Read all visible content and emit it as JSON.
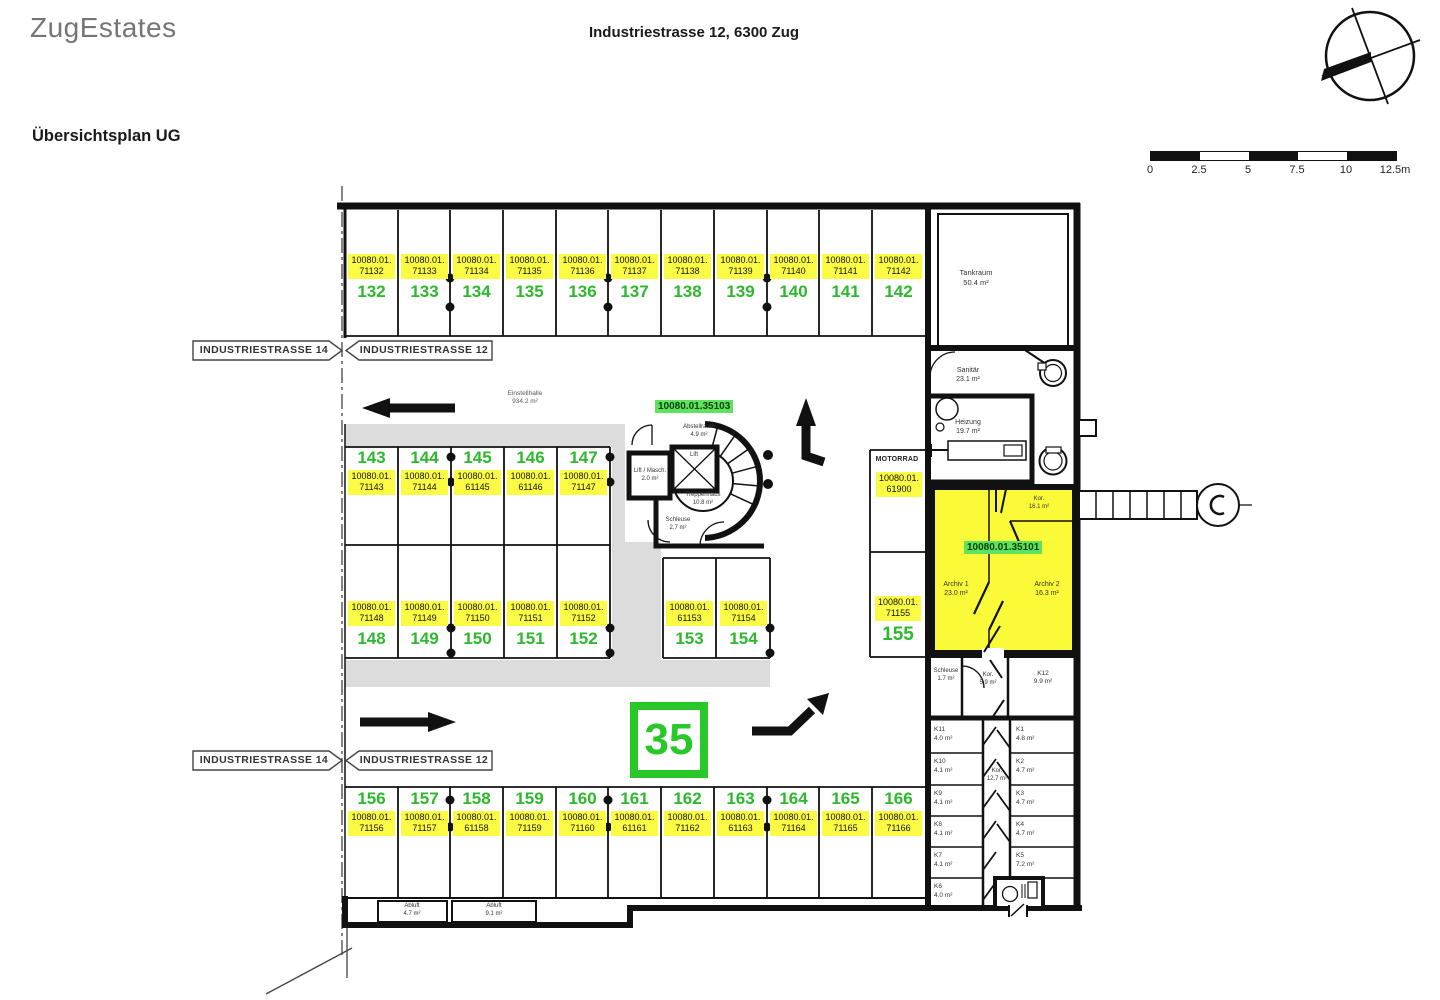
{
  "header": {
    "logo": "ZugEstates",
    "address": "Industriestrasse 12, 6300 Zug",
    "title": "Übersichtsplan UG"
  },
  "scale": {
    "ticks": [
      "0",
      "2.5",
      "5",
      "7.5",
      "10",
      "12.5m"
    ]
  },
  "street": {
    "left_label": "INDUSTRIESTRASSE 14",
    "right_label": "INDUSTRIESTRASSE 12"
  },
  "building_number": "35",
  "units": {
    "archive_unit": "10080.01.35101",
    "stair_unit": "10080.01.35103"
  },
  "stalls": {
    "top": [
      {
        "num": "132",
        "code": "10080.01.\n71132"
      },
      {
        "num": "133",
        "code": "10080.01.\n71133"
      },
      {
        "num": "134",
        "code": "10080.01.\n71134"
      },
      {
        "num": "135",
        "code": "10080.01.\n71135"
      },
      {
        "num": "136",
        "code": "10080.01.\n71136"
      },
      {
        "num": "137",
        "code": "10080.01.\n71137"
      },
      {
        "num": "138",
        "code": "10080.01.\n71138"
      },
      {
        "num": "139",
        "code": "10080.01.\n71139"
      },
      {
        "num": "140",
        "code": "10080.01.\n71140"
      },
      {
        "num": "141",
        "code": "10080.01.\n71141"
      },
      {
        "num": "142",
        "code": "10080.01.\n71142"
      }
    ],
    "mid_upper": [
      {
        "num": "143",
        "code": "10080.01.\n71143"
      },
      {
        "num": "144",
        "code": "10080.01.\n71144"
      },
      {
        "num": "145",
        "code": "10080.01.\n61145"
      },
      {
        "num": "146",
        "code": "10080.01.\n61146"
      },
      {
        "num": "147",
        "code": "10080.01.\n71147"
      }
    ],
    "mid_lower": [
      {
        "num": "148",
        "code": "10080.01.\n71148"
      },
      {
        "num": "149",
        "code": "10080.01.\n71149"
      },
      {
        "num": "150",
        "code": "10080.01.\n71150"
      },
      {
        "num": "151",
        "code": "10080.01.\n71151"
      },
      {
        "num": "152",
        "code": "10080.01.\n71152"
      }
    ],
    "mid_lower2": [
      {
        "num": "153",
        "code": "10080.01.\n61153"
      },
      {
        "num": "154",
        "code": "10080.01.\n71154"
      }
    ],
    "bottom": [
      {
        "num": "156",
        "code": "10080.01.\n71156"
      },
      {
        "num": "157",
        "code": "10080.01.\n71157"
      },
      {
        "num": "158",
        "code": "10080.01.\n61158"
      },
      {
        "num": "159",
        "code": "10080.01.\n71159"
      },
      {
        "num": "160",
        "code": "10080.01.\n71160"
      },
      {
        "num": "161",
        "code": "10080.01.\n61161"
      },
      {
        "num": "162",
        "code": "10080.01.\n71162"
      },
      {
        "num": "163",
        "code": "10080.01.\n61163"
      },
      {
        "num": "164",
        "code": "10080.01.\n71164"
      },
      {
        "num": "165",
        "code": "10080.01.\n71165"
      },
      {
        "num": "166",
        "code": "10080.01.\n71166"
      }
    ],
    "motorrad": {
      "label": "MOTORRAD",
      "code": "10080.01.\n61900"
    },
    "stall155": {
      "num": "155",
      "code": "10080.01.\n71155"
    }
  },
  "rooms": {
    "einstellhalle": "Einstellhalle\n934.2 m²",
    "tankraum": "Tankraum\n50.4 m²",
    "sanitaer": "Sanitär\n23.1 m²",
    "heizung": "Heizung\n19.7 m²",
    "abstellraum": "Abstellraum\n4.9 m²",
    "lift": "Lift",
    "lift_masch": "Lift / Masch.\n2.0 m²",
    "treppenhaus": "Treppenhaus\n10.8 m²",
    "schleuse": "Schleuse\n2.7 m²",
    "archiv1": "Archiv 1\n23.0 m²",
    "archiv2": "Archiv 2\n16.3 m²",
    "kor_archiv": "Kor.\n16.1 m²",
    "abluft1": "Abluft\n4.7 m²",
    "abluft2": "Abluft\n9.1 m²",
    "schleuse2": "Schleuse\n1.7 m²",
    "kor_small": "Kor.\n5.9 m²",
    "k12": "K12\n9.9 m²",
    "kor_mid": "Kor.\n12.7 m²",
    "keller_left": [
      "K11\n4.0 m²",
      "K10\n4.1 m²",
      "K9\n4.1 m²",
      "K8\n4.1 m²",
      "K7\n4.1 m²",
      "K6\n4.0 m²"
    ],
    "keller_right": [
      "K1\n4.8 m²",
      "K2\n4.7 m²",
      "K3\n4.7 m²",
      "K4\n4.7 m²",
      "K5\n7.2 m²"
    ]
  }
}
